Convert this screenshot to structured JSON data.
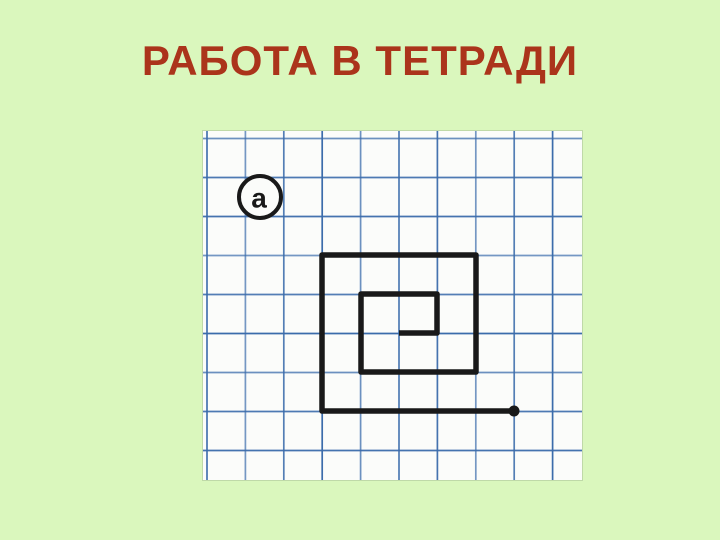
{
  "slide": {
    "title": "РАБОТА В ТЕТРАДИ",
    "background_color": "#daf7bd",
    "title_color": "#ab341b"
  },
  "figure": {
    "paper": {
      "left": 203,
      "top": 131,
      "width": 379,
      "height": 349,
      "color": "#fbfcfa"
    },
    "grid": {
      "color": "#3b6cab",
      "line_width": 1.7,
      "cell_width": 38.4,
      "cell_height": 39,
      "offset_x": 4,
      "offset_y": 7.5
    },
    "label": {
      "text": "а",
      "cx": 57,
      "cy": 66,
      "r": 21,
      "stroke_width": 4,
      "font_size": 28
    },
    "spiral": {
      "color": "#191919",
      "stroke_width": 5.5,
      "dot_radius": 5.5,
      "points": [
        [
          311,
          280
        ],
        [
          119,
          280
        ],
        [
          119,
          124
        ],
        [
          273,
          124
        ],
        [
          273,
          241
        ],
        [
          158,
          241
        ],
        [
          158,
          163
        ],
        [
          234,
          163
        ],
        [
          234,
          202
        ],
        [
          196,
          202
        ]
      ]
    }
  }
}
